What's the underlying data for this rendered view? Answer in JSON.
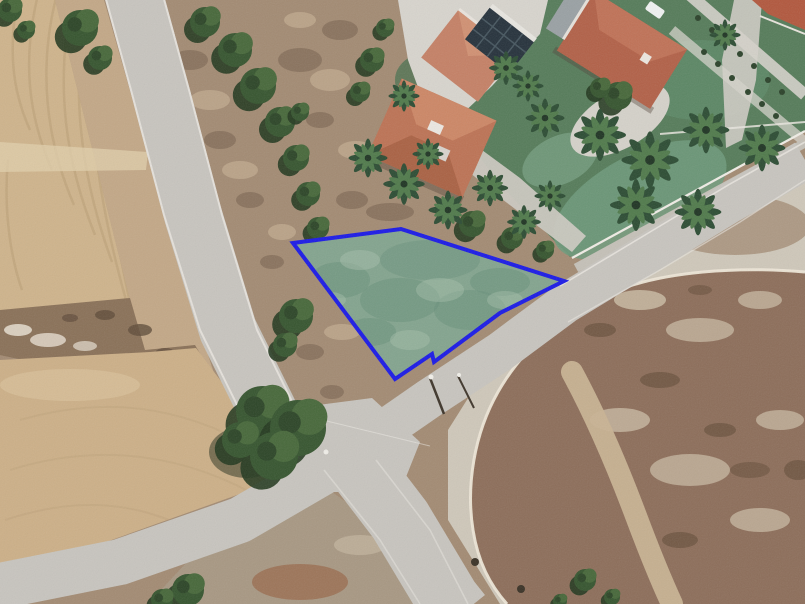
{
  "page": {
    "kind": "aerial-satellite-photo",
    "annotation": "highlighted land parcel boundary",
    "image_size": {
      "width": 805,
      "height": 604
    }
  },
  "parcel": {
    "outline_points": "293,243 401,229 564,281 500,313 434,362 432,354 395,379",
    "stroke": "#1b1ae6",
    "stroke_width": 4,
    "fill": "#7fa691",
    "fill_opacity": 0.9,
    "vertex_count": 7
  },
  "palette": {
    "scrub": "#a38b73",
    "field_top_left": "#cfb48c",
    "field_bottom_left": "#cdb088",
    "field_rough_strip": "#8a7158",
    "field_margin": "#c3a887",
    "road": "#c8c5bf",
    "road_edge_line": "#eae7e1",
    "road_shoulder": "#cfc8ba",
    "sidewalk": "#c5c1b8",
    "fence_wall": "#f0ede6",
    "lawn": "#567c5a",
    "lawn_teal": "#6f9b7d",
    "concrete": "#d8d5ce",
    "roof_house_lower": "#bd7355",
    "roof_house_upper": "#c58166",
    "roof_house_right": "#b26148",
    "roof_corner_house": "#b2583e",
    "solar_panels": "#26323c",
    "dirt_field": "#8d6e5a",
    "dirt_track": "#c9b394",
    "curb_arc": "#eee7d8"
  },
  "features": [
    "rural crossroads with four road arms",
    "plowed agricultural fields on the west side",
    "villas with terracotta roofs and rooftop solar panels to the north",
    "landscaped gardens with palm trees",
    "scrubland with tree clusters along the road",
    "open dirt field with curved white access track to the southeast",
    "blue-outlined land parcel in the centre"
  ]
}
